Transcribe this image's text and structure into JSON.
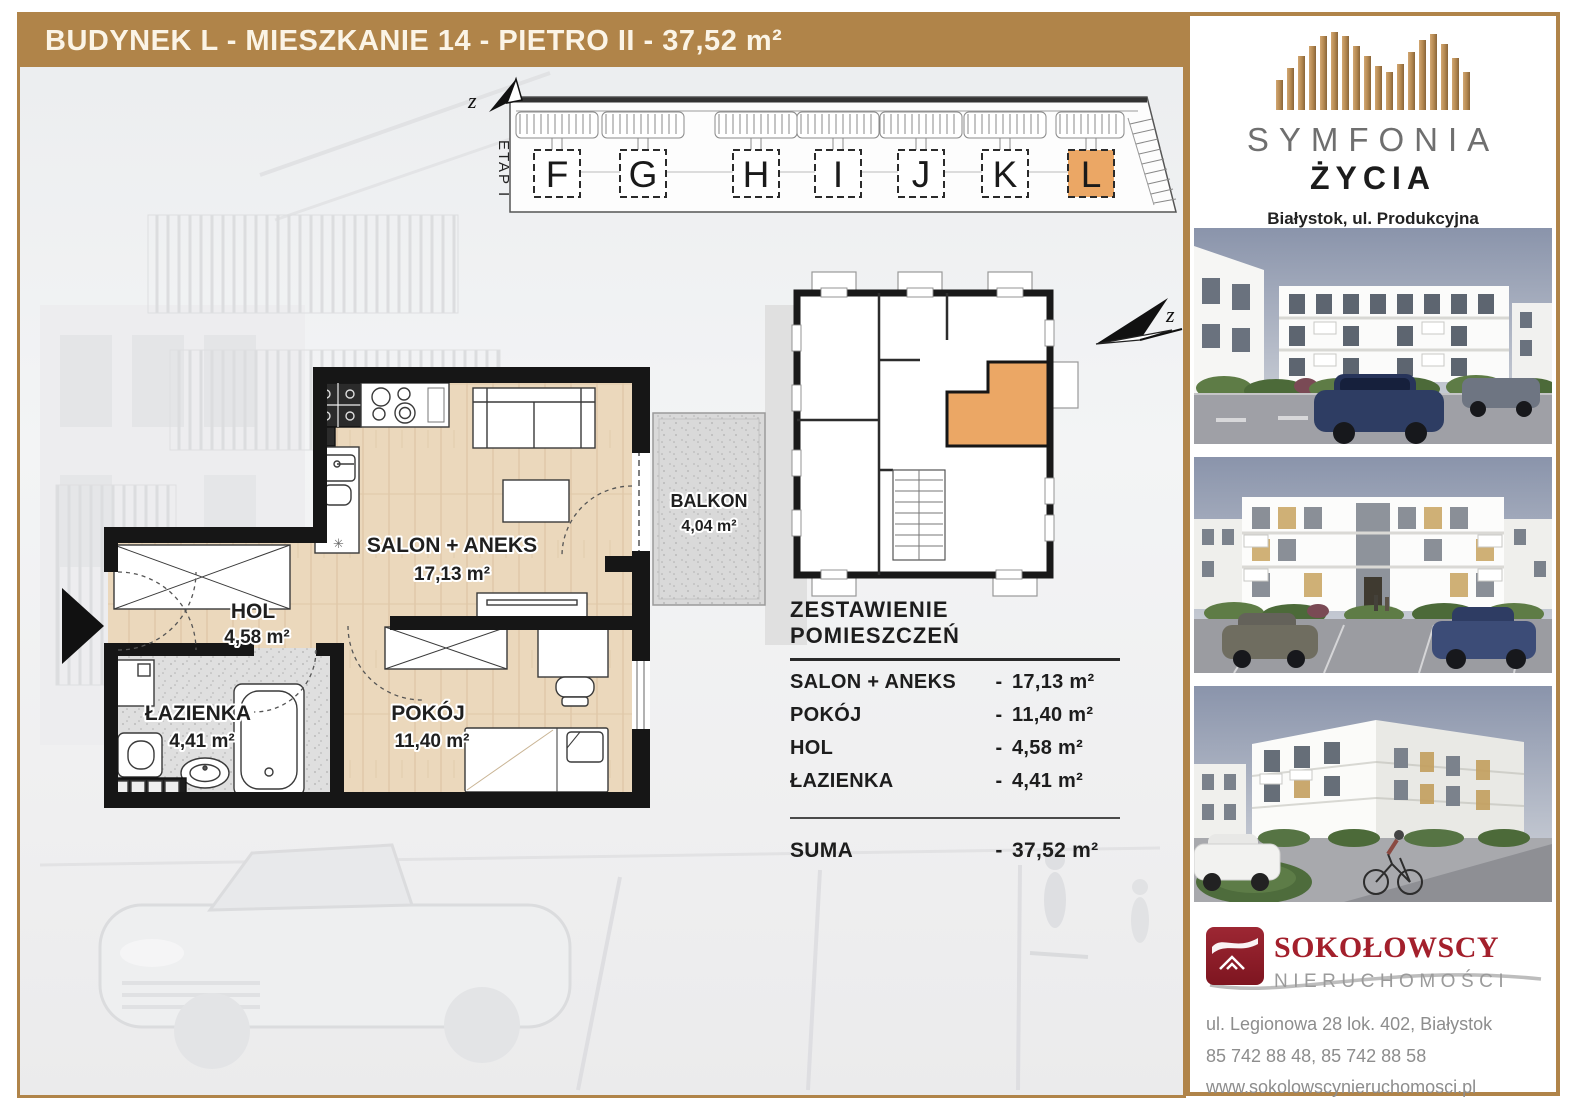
{
  "header": {
    "title": "BUDYNEK L - MIESZKANIE 14 - PIETRO II - 37,52 m²"
  },
  "site_plan": {
    "etap_label": "ETAP I",
    "north_label": "z",
    "buildings": [
      "F",
      "G",
      "H",
      "I",
      "J",
      "K",
      "L"
    ],
    "highlighted_building": "L"
  },
  "floor_plan": {
    "rooms": [
      {
        "name": "SALON + ANEKS",
        "area": "17,13 m²"
      },
      {
        "name": "HOL",
        "area": "4,58 m²"
      },
      {
        "name": "ŁAZIENKA",
        "area": "4,41 m²"
      },
      {
        "name": "POKÓJ",
        "area": "11,40 m²"
      },
      {
        "name": "BALKON",
        "area": "4,04 m²"
      }
    ]
  },
  "summary": {
    "title": "ZESTAWIENIE POMIESZCZEŃ",
    "dash": "-",
    "rows": [
      {
        "name": "SALON + ANEKS",
        "area": "17,13 m²"
      },
      {
        "name": "POKÓJ",
        "area": "11,40 m²"
      },
      {
        "name": "HOL",
        "area": "4,58 m²"
      },
      {
        "name": "ŁAZIENKA",
        "area": "4,41 m²"
      }
    ],
    "total_label": "SUMA",
    "total_area": "37,52 m²"
  },
  "sidebar": {
    "brand": {
      "line1": "SYMFONIA",
      "line2": "ŻYCIA",
      "location": "Białystok, ul. Produkcyjna"
    },
    "agency": {
      "name": "SOKOŁOWSCY",
      "subtitle": "NIERUCHOMOŚCI",
      "address": "ul. Legionowa 28 lok. 402, Białystok",
      "phones": "85 742 88 48,  85 742 88 58",
      "website": "www.sokolowscynieruchomosci.pl"
    }
  },
  "colors": {
    "accent_brown": "#B08449",
    "highlight_orange": "#EBA765",
    "agency_red": "#A3202C"
  }
}
